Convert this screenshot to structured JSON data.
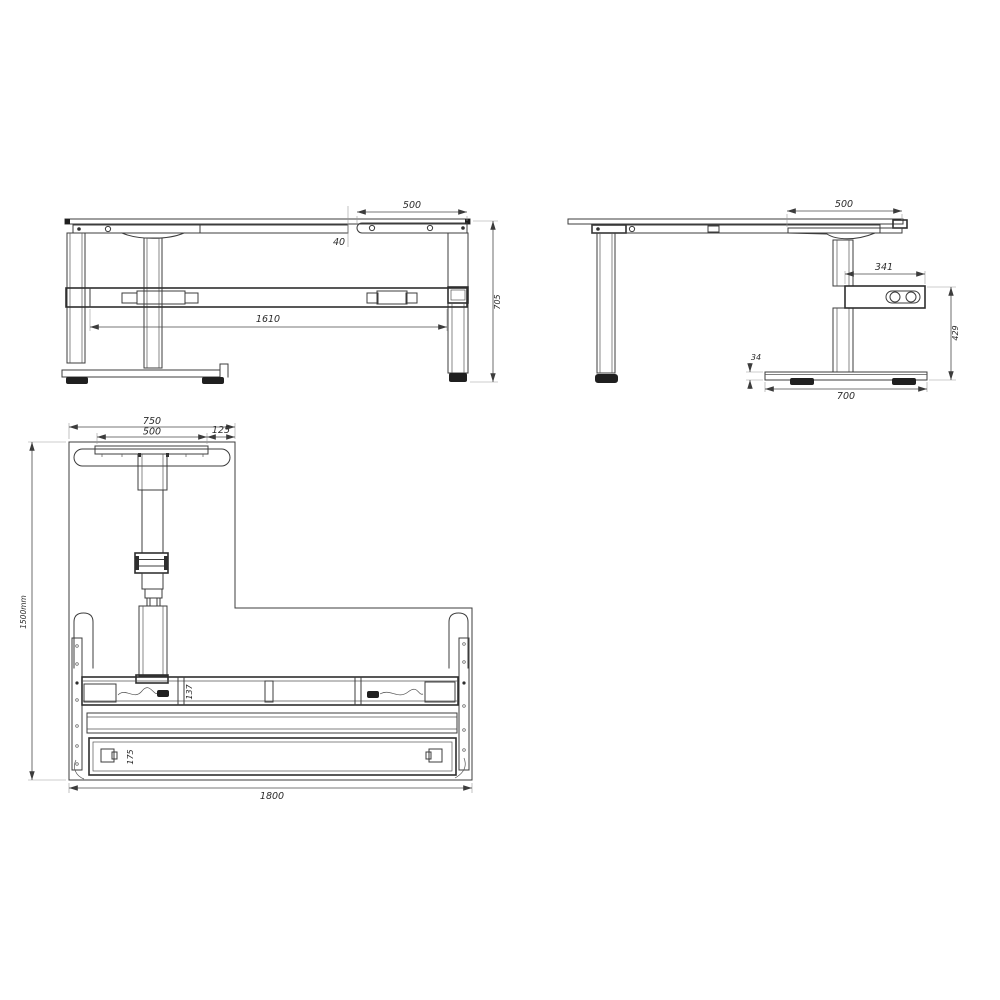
{
  "page": {
    "background": "#ffffff",
    "line_color": "#3c3c3c",
    "dimension_color": "#4a4a4a",
    "extension_color": "#9a9a9a"
  },
  "views": {
    "front": {
      "dims": {
        "overhang": "500",
        "rail_gap": "40",
        "leg_spacing": "1610",
        "height": "705"
      }
    },
    "side": {
      "dims": {
        "top_depth": "500",
        "control_box_length": "341",
        "box_floor_height": "429",
        "foot_height": "34",
        "foot_length": "700"
      }
    },
    "plan": {
      "dims": {
        "arm_width": "750",
        "plate_width": "500",
        "edge_offset": "125",
        "depth": "1500mm",
        "beam_depth": "137",
        "foot_depth": "175",
        "overall_width": "1800"
      }
    }
  }
}
